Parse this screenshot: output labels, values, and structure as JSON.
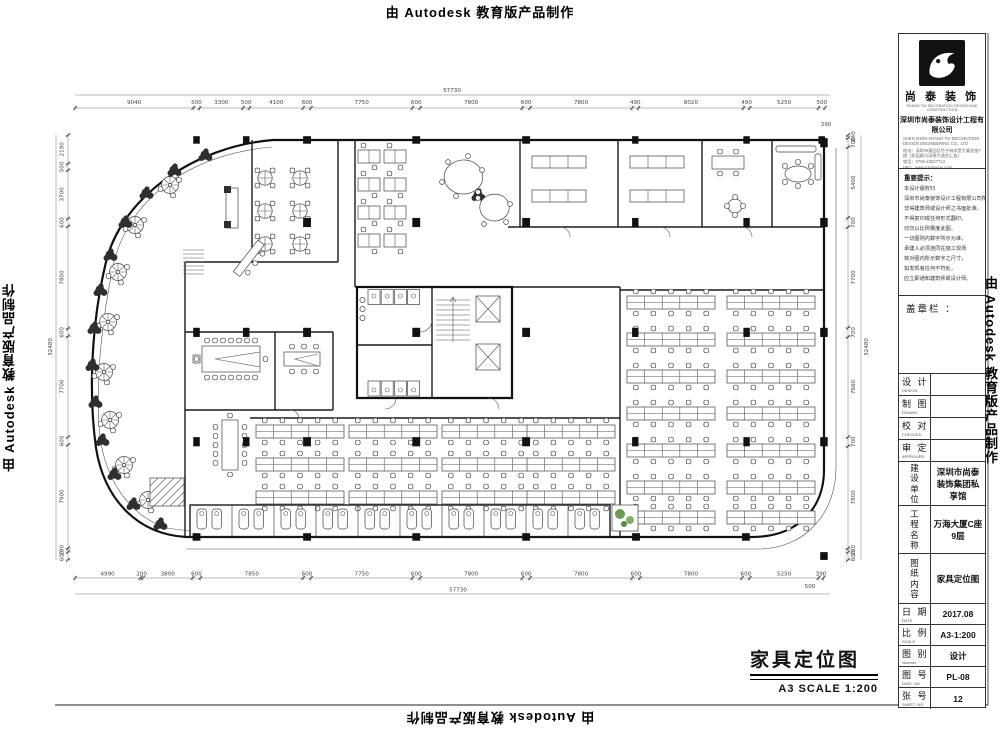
{
  "banners": {
    "autodesk": "由 Autodesk 教育版产品制作"
  },
  "footer": {
    "title": "家具定位图",
    "scale_note": "A3   SCALE 1:200"
  },
  "title_block": {
    "brand": {
      "name": "尚 泰 装 饰",
      "name_en": "SHANG TAI DECORATION DESIGN AND CONSTRUCTION",
      "company": "深圳市尚泰装饰设计工程有限公司",
      "company_en": "SHEN ZHEN SHANG TAI DECORATION DESIGN ENGINEERING CO., LTD",
      "address": "地址：深圳市福田区竹子林求是大厦北座7楼（彩田路与深南大道交汇处）",
      "phone": "电话：0755-23227713",
      "web": "Http：www.sztahome.com"
    },
    "notice": {
      "title": "重要提示：",
      "lines": [
        "本设计版权归",
        "深圳市尚泰装饰设计工程有限公司所有，",
        "非得建筑师或设计师之书面批准，",
        "不得复印或任何形式翻印。",
        "切勿以比例量度此图。",
        "一切图则内数字所示为准，",
        "承建人必须连同在施工现场",
        "核对图内所示数字之尺寸，",
        "如发现有任何不符处，",
        "应立即通知建筑师或设计师。"
      ]
    },
    "stamp_label": "盖章栏 ：",
    "sign_rows": [
      {
        "zh": "设 计",
        "en": "DESIGN"
      },
      {
        "zh": "制 图",
        "en": "DRAWN"
      },
      {
        "zh": "校 对",
        "en": "CHECKED"
      },
      {
        "zh": "审 定",
        "en": "APPROVER"
      }
    ],
    "info_rows": [
      {
        "zh": "建设单位",
        "value": "深圳市尚泰装饰集团私享馆"
      },
      {
        "zh": "工程名称",
        "value": "万海大厦C座9层"
      },
      {
        "zh": "图纸内容",
        "value": "家具定位图"
      }
    ],
    "meta_rows": [
      {
        "zh": "日 期",
        "en": "DATE",
        "value": "2017.08"
      },
      {
        "zh": "比 例",
        "en": "SCALE",
        "value": "A3-1:200"
      },
      {
        "zh": "图 别",
        "en": "Number",
        "value": "设计"
      },
      {
        "zh": "图 号",
        "en": "DWG. NO",
        "value": "PL-08"
      },
      {
        "zh": "张 号",
        "en": "SHEET. NO",
        "value": "12"
      }
    ]
  },
  "dims": {
    "px_per_mm": 0.01308,
    "origin": {
      "x": 75,
      "y": 135
    },
    "top": {
      "overall": "57730",
      "segments": [
        9040,
        500,
        3300,
        500,
        4100,
        600,
        7750,
        600,
        7800,
        600,
        7800,
        490,
        8020,
        490,
        5250,
        500
      ],
      "edge": "390"
    },
    "bottom": {
      "overall": "57730",
      "segments": [
        4990,
        200,
        3800,
        600,
        7850,
        600,
        7750,
        600,
        7800,
        600,
        7800,
        600,
        7800,
        600,
        5250,
        390
      ],
      "edge": "500"
    },
    "left": {
      "overall": "32480",
      "segments": [
        2190,
        500,
        3700,
        600,
        7800,
        600,
        7700,
        600,
        7900,
        290,
        600
      ]
    },
    "right": {
      "overall": "32480",
      "segments": [
        240,
        700,
        5400,
        700,
        7700,
        700,
        7660,
        700,
        7800,
        290,
        600
      ]
    }
  }
}
